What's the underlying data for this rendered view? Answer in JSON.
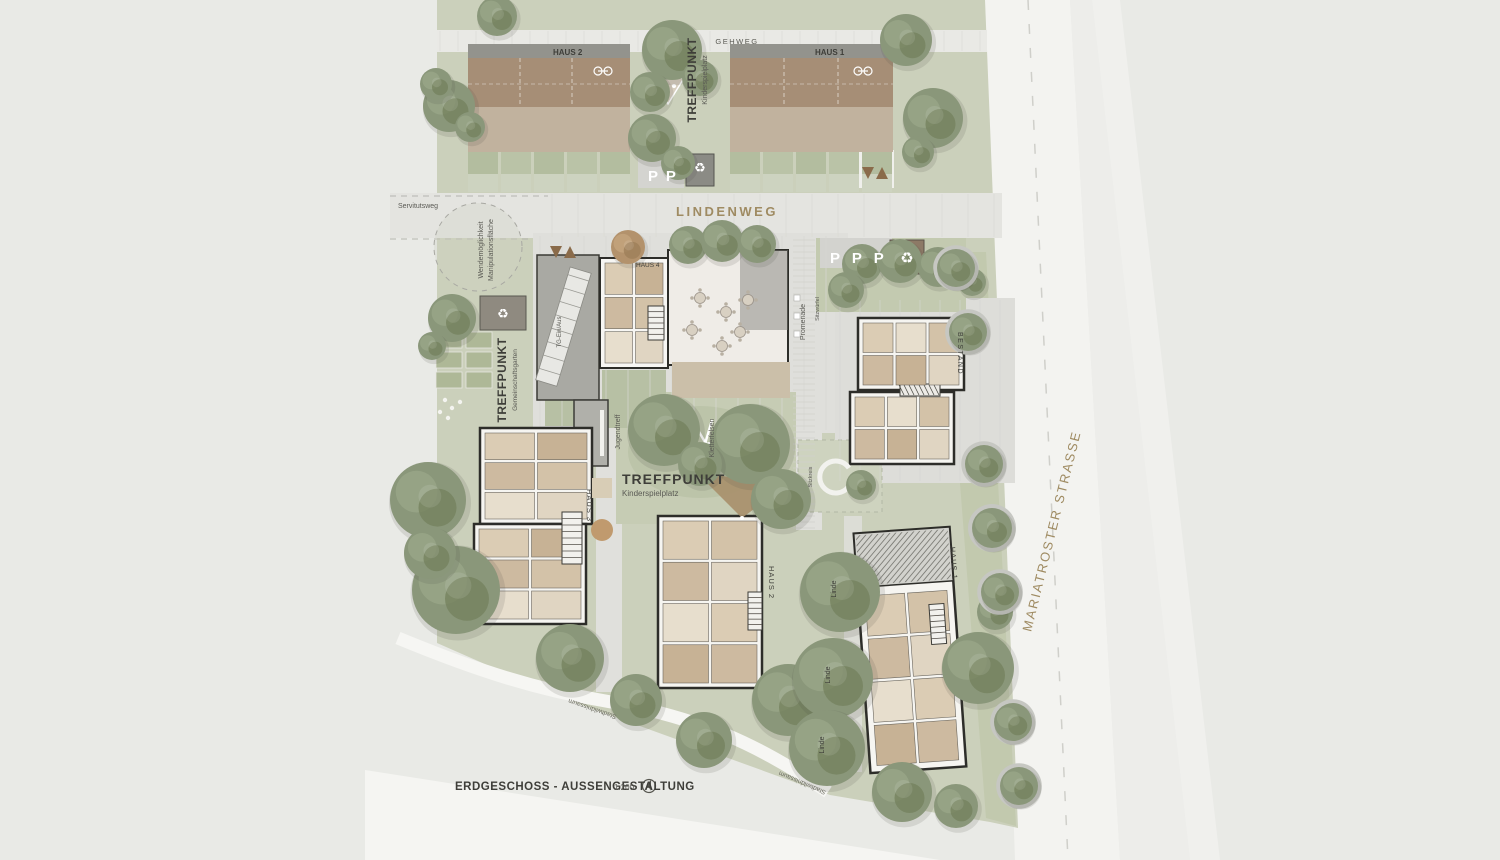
{
  "title_block": {
    "title": "ERDGESCHOSS - AUSSENGESTALTUNG",
    "scale": "1:200"
  },
  "streets": {
    "gehweg": "GEHWEG",
    "lindenweg": "LINDENWEG",
    "servitutsweg": "Servitutsweg",
    "mariatroster_strasse": "MARIATROSTER STRASSE"
  },
  "buildings": {
    "haus2_nord": "HAUS 2",
    "haus1_nord": "HAUS 1",
    "haus4": "HAUS 4",
    "bestand": "BESTAND",
    "haus3": "HAUS 3",
    "haus2_sued": "HAUS 2",
    "haus1_sued": "HAUS 1"
  },
  "meeting_points": {
    "nord": {
      "title": "TREFFPUNKT",
      "subtitle": "Kinderspielplatz"
    },
    "west": {
      "title": "TREFFPUNKT",
      "subtitle": "Gemeinschaftsgarten"
    },
    "mitte": {
      "title": "TREFFPUNKT",
      "subtitle": "Kinderspielplatz"
    }
  },
  "site_labels": {
    "wendemoeglichkeit": "Wendemöglichkeit",
    "manipulationsflaeche": "Manipulationsfläche",
    "tg_ein_aus": "TG-Ein/Aus",
    "promenade": "Promenade",
    "sitzwuerfel": "Sitzwürfel",
    "jugendtreff": "Jugendtreff",
    "kletterfelsen": "Kletterfelsen",
    "sitzkreis": "Sitzkreis",
    "linde": "Linde",
    "stadtwildnissaum": "Stadtwildnissaum",
    "parking_nord": "P P",
    "parking_ost": "P P P"
  },
  "icons": {
    "recycle": "♻"
  },
  "colors": {
    "background": "#e9eae6",
    "lawn": "#cbd0bb",
    "paving": "#dfdfdb",
    "road_white": "#f3f3f0",
    "roof_brown": "#a68e76",
    "terrace_tan": "#c1b29e",
    "wall_dark": "#2d2d29",
    "tree_green": "#8a977a",
    "street_label_brown": "#9f8b62",
    "label_dark": "#3e3e39"
  }
}
